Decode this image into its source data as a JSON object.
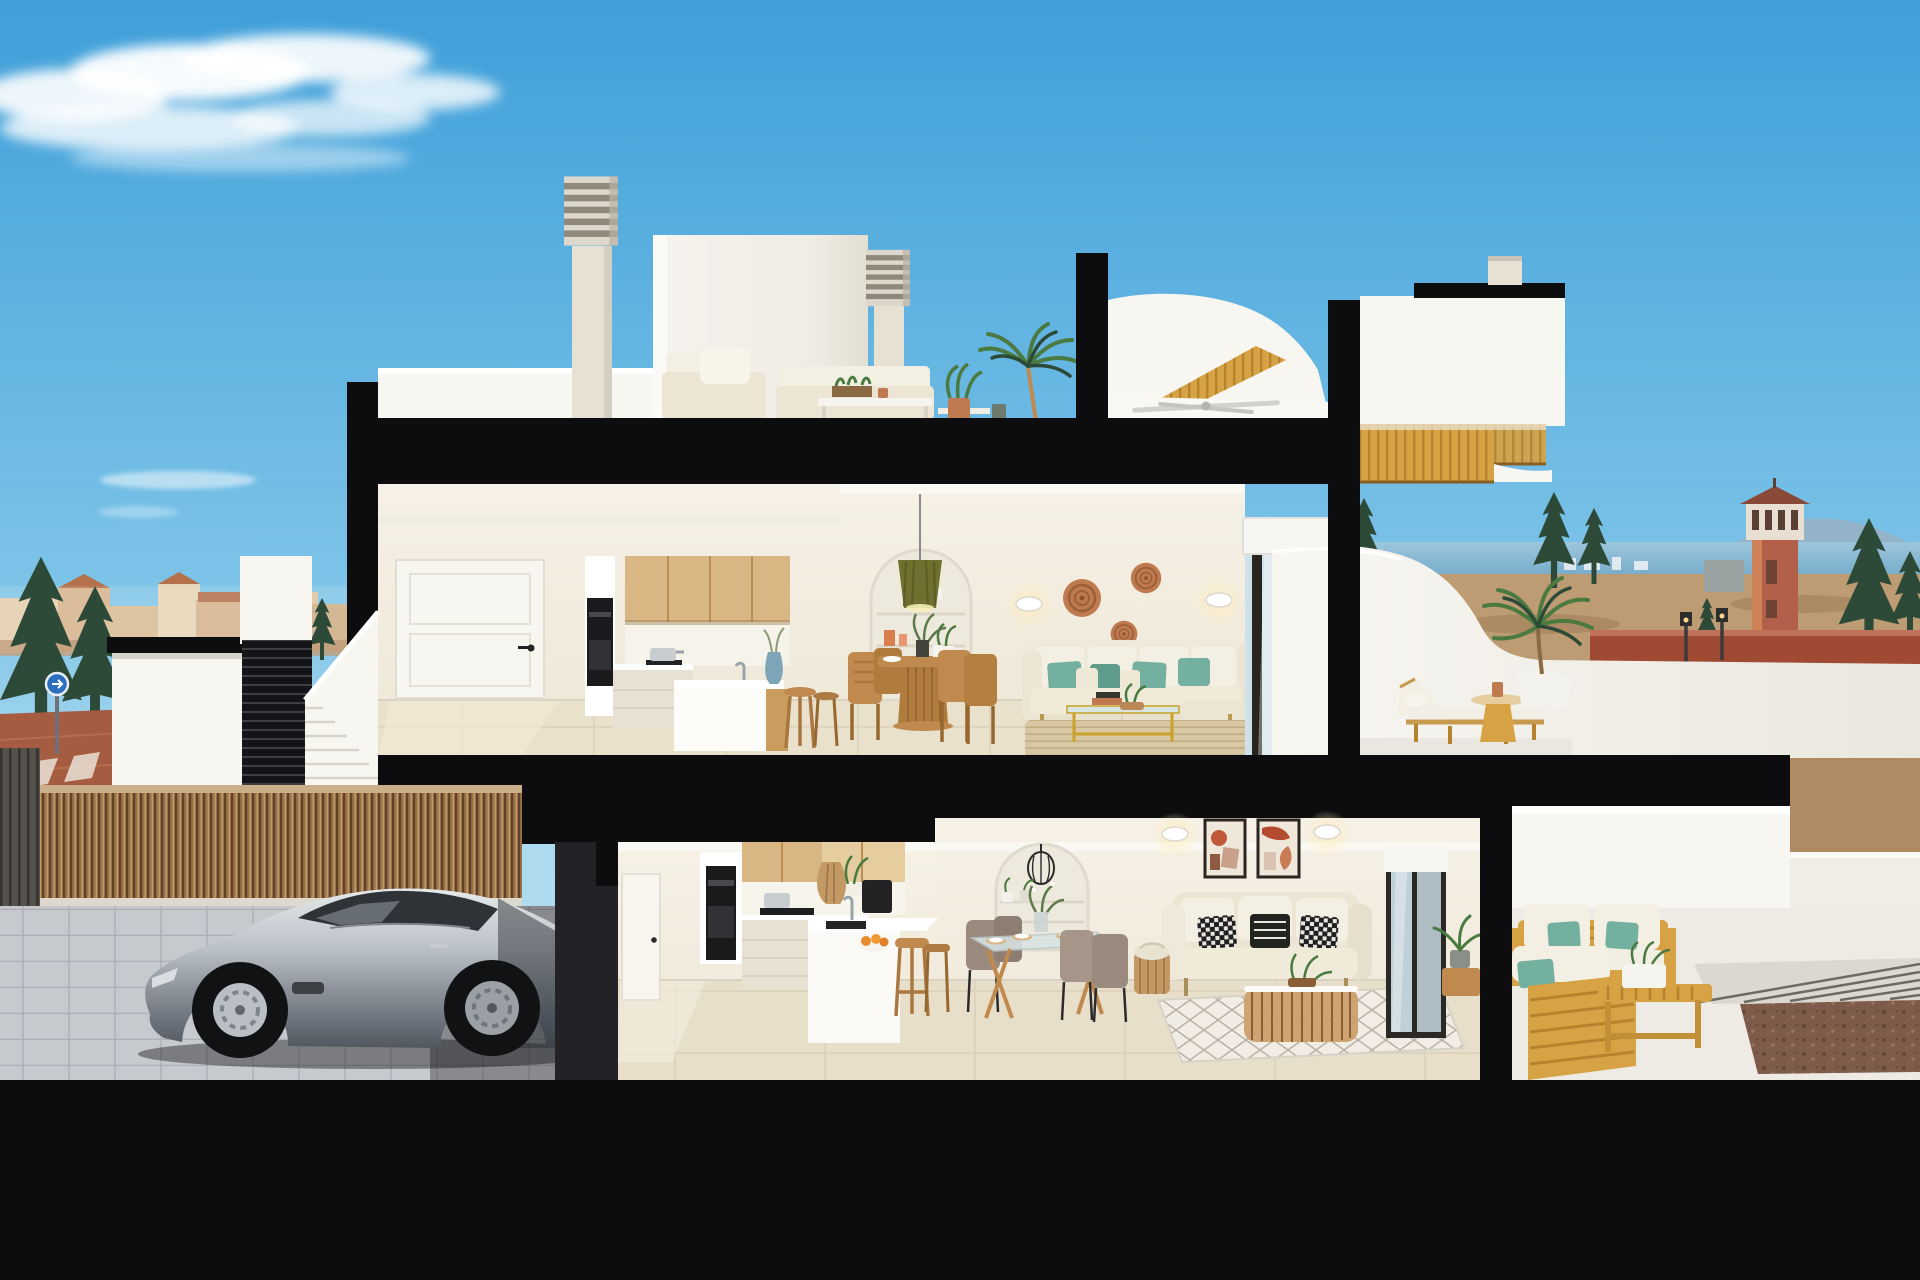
{
  "meta": {
    "title": "Cross-section render of a two-storey coastal villa with rooftop solarium, carport and terraces",
    "image_type": "photorealistic architectural cutaway render",
    "time_of_day": "daytime, clear blue sky"
  },
  "palette": {
    "ink": "#0d0d0f",
    "sky_top": "#3f9fd9",
    "sky_mid": "#7cc3e8",
    "sky_low": "#aad9ee",
    "cloud": "#ffffff",
    "wall_bright": "#f8f6f1",
    "wall_cream": "#f3eee3",
    "wall_dim": "#e7e1d3",
    "ceiling": "#faf8f2",
    "floor_upper": "#eae1cd",
    "floor_ground": "#e8dfcb",
    "tile_joint": "#d6cbb2",
    "wood_cabinet": "#d9b784",
    "wood_cabinet_dark": "#c89d5e",
    "wood_light": "#e6cd9f",
    "wood_gold": "#d7a243",
    "wood_gold_dark": "#b5832e",
    "wood_warm": "#c08a4e",
    "reed": "#9b7248",
    "reed_dark": "#5f4228",
    "olive": "#6f7030",
    "teal": "#74b0a0",
    "teal_dark": "#5f9c8c",
    "sofa_cream": "#ece5d3",
    "cushion_white": "#f3efe2",
    "rattan": "#c49a64",
    "terracotta": "#c07a50",
    "rug_jute": "#d9c8a4",
    "rug_white": "#f1ede4",
    "car_high": "#e6e9eb",
    "car_mid": "#8d949c",
    "car_dark": "#4e555e",
    "glass_dark": "#2e3338",
    "sea": "#74aac9",
    "mountain": "#97b0c4",
    "town_wall": "#d8b48e",
    "town_roof": "#b4714c",
    "tree": "#2c4a37",
    "tree_light": "#4a7a40",
    "terrain": "#bd9c73",
    "brick": "#a04a34",
    "sidewalk": "#a65c41",
    "road": "#8d8e92",
    "gravel": "#7d5a49",
    "paver": "#c6c9cd",
    "paver_joint": "#aab0b6",
    "blind": "#f6f6f3",
    "glass_blue": "#cfe2ec",
    "metal": "#c8cdd2"
  },
  "scene": {
    "sky": {
      "clouds": {
        "large_wispy": 1,
        "small_faint": 2
      }
    },
    "background_left": {
      "town": "low terracotta-roofed buildings at dusk light",
      "trees": "dark conifer trees",
      "street": [
        "red-brown paved sidewalk",
        "grey road with white lane dashes",
        "blue circular road sign on pole"
      ],
      "garden_wall": "white wall with black coping"
    },
    "background_right": {
      "sea": "blue sea band with distant white skyline",
      "mountains": "hazy blue headland",
      "watchtower": "terracotta tower with arched lookout and pyramid roof",
      "trees": "conifers",
      "terrain": "tan scrubland with red-brick wall",
      "street_lamps": 2,
      "distant_wall": "white wall with dark doorway"
    },
    "rooftop": {
      "elements": [
        "louvered chimney stack",
        "second louvered chimney",
        "white stair bulkhead",
        "white outdoor lounge set with cushions",
        "coffee table with planter",
        "potted plants",
        "tall palm",
        "ceiling fan under porch",
        "golden wood stair flight",
        "white curved wing",
        "black cut slab"
      ]
    },
    "upper_floor": {
      "kitchen": [
        "white interior door",
        "tall unit with built-in black oven",
        "light oak upper cabinets",
        "white base cabinets",
        "cooktop with pot",
        "white island with oak side",
        "two oak bar stools",
        "blue vase"
      ],
      "dining": [
        "round oak pedestal table",
        "four slatted oak chairs",
        "place settings",
        "green centerpiece"
      ],
      "living": [
        "arched shelving niche with vases and plant",
        "olive pendant lamp",
        "two wall sconces",
        "three rattan wall baskets",
        "cream L-shaped sofa with teal pillows",
        "gold & glass coffee table",
        "jute rug"
      ],
      "opening": "sliding glass door with white roller blind"
    },
    "upper_terrace": {
      "elements": [
        "golden slatted pergola overhang",
        "curved white parapet",
        "wooden sun lounger with white cushion",
        "round wooden side table with clay pot",
        "palm in white planter"
      ]
    },
    "ground_floor": {
      "carport": [
        "reed bamboo fence",
        "grey slatted gate",
        "cobble paver floor",
        "silver sports coupe"
      ],
      "kitchen": [
        "white side door",
        "black built-in oven",
        "two-tone oak upper cabinets",
        "white base units",
        "cooktop with pot",
        "coffee machine",
        "rattan shade",
        "white peninsula with sink",
        "fruit bowl with oranges",
        "oak bar stools"
      ],
      "dining": [
        "glass-top table with oak A-legs",
        "four taupe chairs",
        "place settings",
        "green centerpiece",
        "arched niche with black cage pendant and plants"
      ],
      "living": [
        "two framed terracotta abstract artworks",
        "two wall sconces",
        "cream loveseat with black & white pillows",
        "side basket with throw",
        "open-weave rattan coffee table with plant",
        "white diamond-pattern rug"
      ],
      "opening": "dark-framed sliding glass door with blind and potted plant"
    },
    "ground_terrace": {
      "elements": [
        "white stepped back wall",
        "golden wood outdoor sofa pair with white cushions and turquoise pillows",
        "slatted wood coffee bench with white planter",
        "paver strip",
        "brown gravel bed"
      ]
    },
    "cut_structure": "thick black lines where floor slabs and walls are sectioned"
  }
}
